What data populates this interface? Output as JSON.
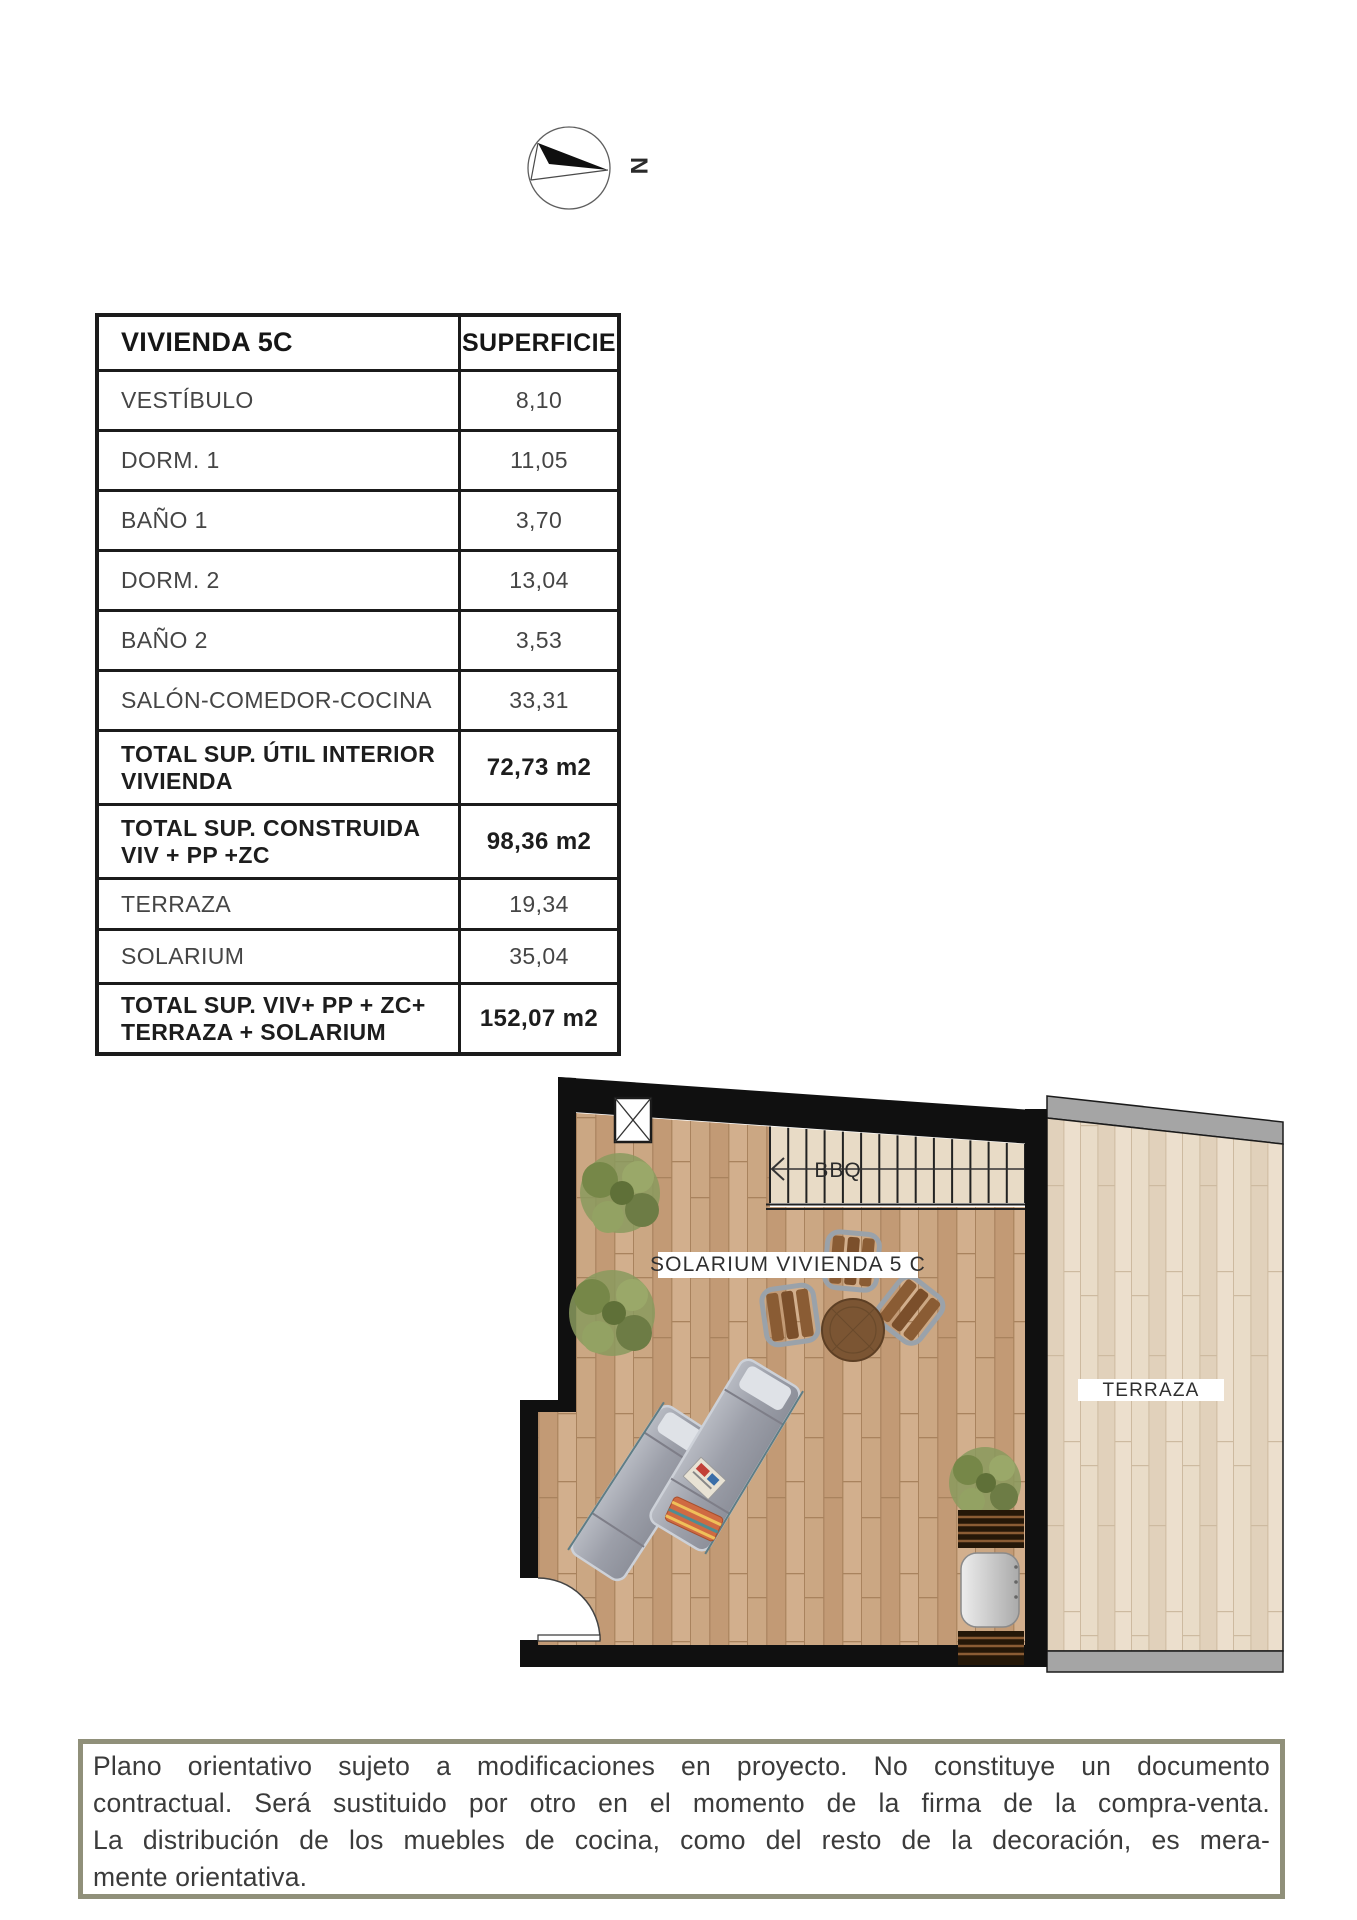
{
  "compass": {
    "north_label": "N"
  },
  "table": {
    "header": {
      "name": "VIVIENDA 5C",
      "value": "SUPERFICIE"
    },
    "rows": [
      {
        "label": "VESTÍBULO",
        "value": "8,10"
      },
      {
        "label": "DORM. 1",
        "value": "11,05"
      },
      {
        "label": "BAÑO 1",
        "value": "3,70"
      },
      {
        "label": "DORM. 2",
        "value": "13,04"
      },
      {
        "label": "BAÑO 2",
        "value": "3,53"
      },
      {
        "label": "SALÓN-COMEDOR-COCINA",
        "value": "33,31"
      },
      {
        "label": "TOTAL SUP. ÚTIL INTERIOR VIVIENDA",
        "value": "72,73 m2"
      },
      {
        "label": "TOTAL SUP. CONSTRUIDA VIV + PP +ZC",
        "value": "98,36 m2"
      },
      {
        "label": "TERRAZA",
        "value": "19,34"
      },
      {
        "label": "SOLARIUM",
        "value": "35,04"
      },
      {
        "label": "TOTAL SUP. VIV+ PP + ZC+ TERRAZA + SOLARIUM",
        "value": "152,07 m2"
      }
    ]
  },
  "plan": {
    "solarium_label": "SOLARIUM VIVIENDA 5 C",
    "terraza_label": "TERRAZA",
    "bbq_label": "BBQ"
  },
  "disclaimer": {
    "lines": [
      "Plano orientativo sujeto a modificaciones en proyecto. No constituye un documento",
      "contractual. Será sustituido por otro en el momento de la firma de la compra-venta.",
      "La distribución de los muebles de cocina, como del resto de la decoración, es mera-",
      "mente orientativa."
    ]
  }
}
